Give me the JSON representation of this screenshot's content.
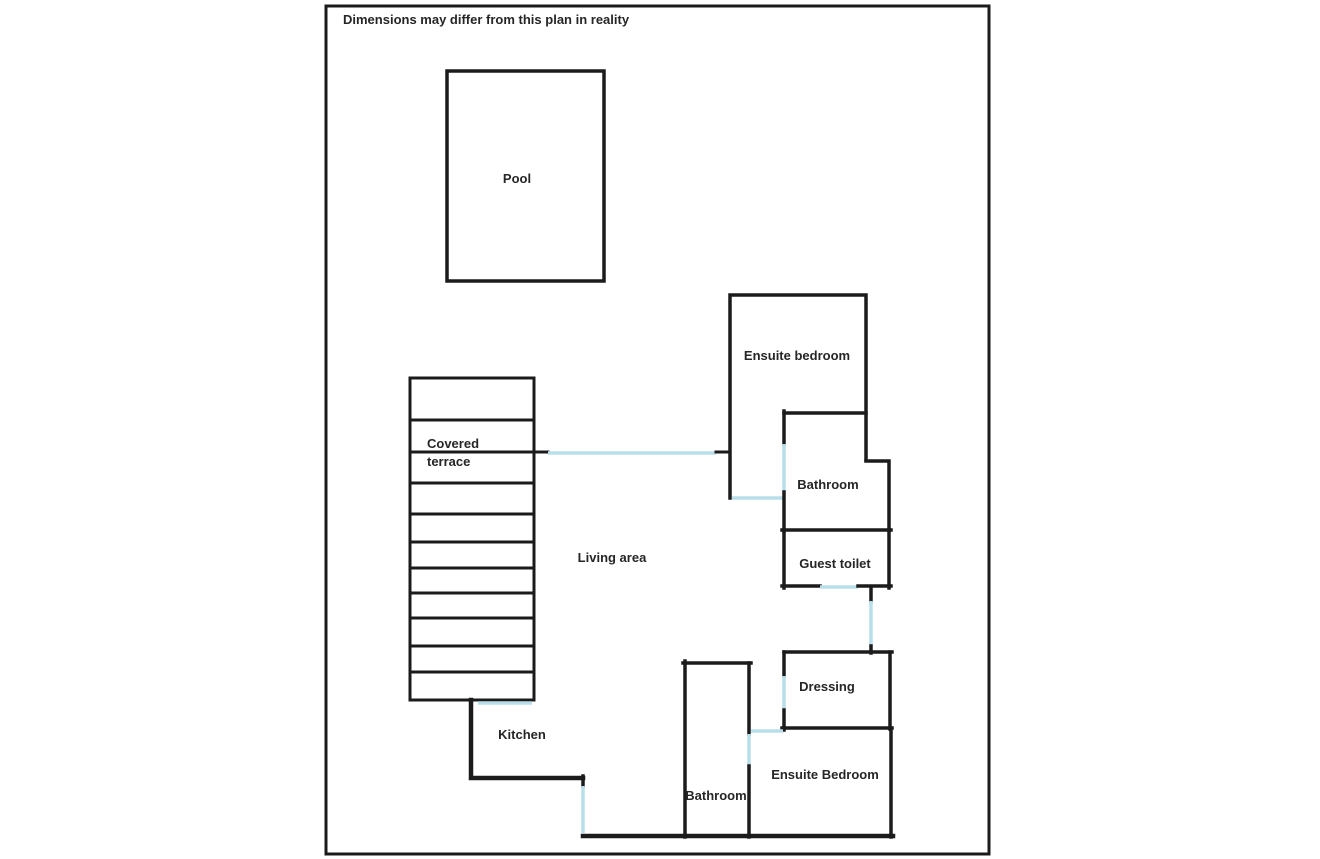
{
  "disclaimer": "Dimensions may differ from this plan in reality",
  "colors": {
    "wall": "#1b1b1b",
    "door": "#b9dee9",
    "background": "#ffffff"
  },
  "rooms": {
    "pool": "Pool",
    "covered_terrace_line1": "Covered",
    "covered_terrace_line2": "terrace",
    "living_area": "Living area",
    "kitchen": "Kitchen",
    "ensuite_bedroom_top": "Ensuite bedroom",
    "bathroom_top": "Bathroom",
    "guest_toilet": "Guest toilet",
    "dressing": "Dressing",
    "ensuite_bedroom_bottom": "Ensuite Bedroom",
    "bathroom_bottom": "Bathroom"
  }
}
